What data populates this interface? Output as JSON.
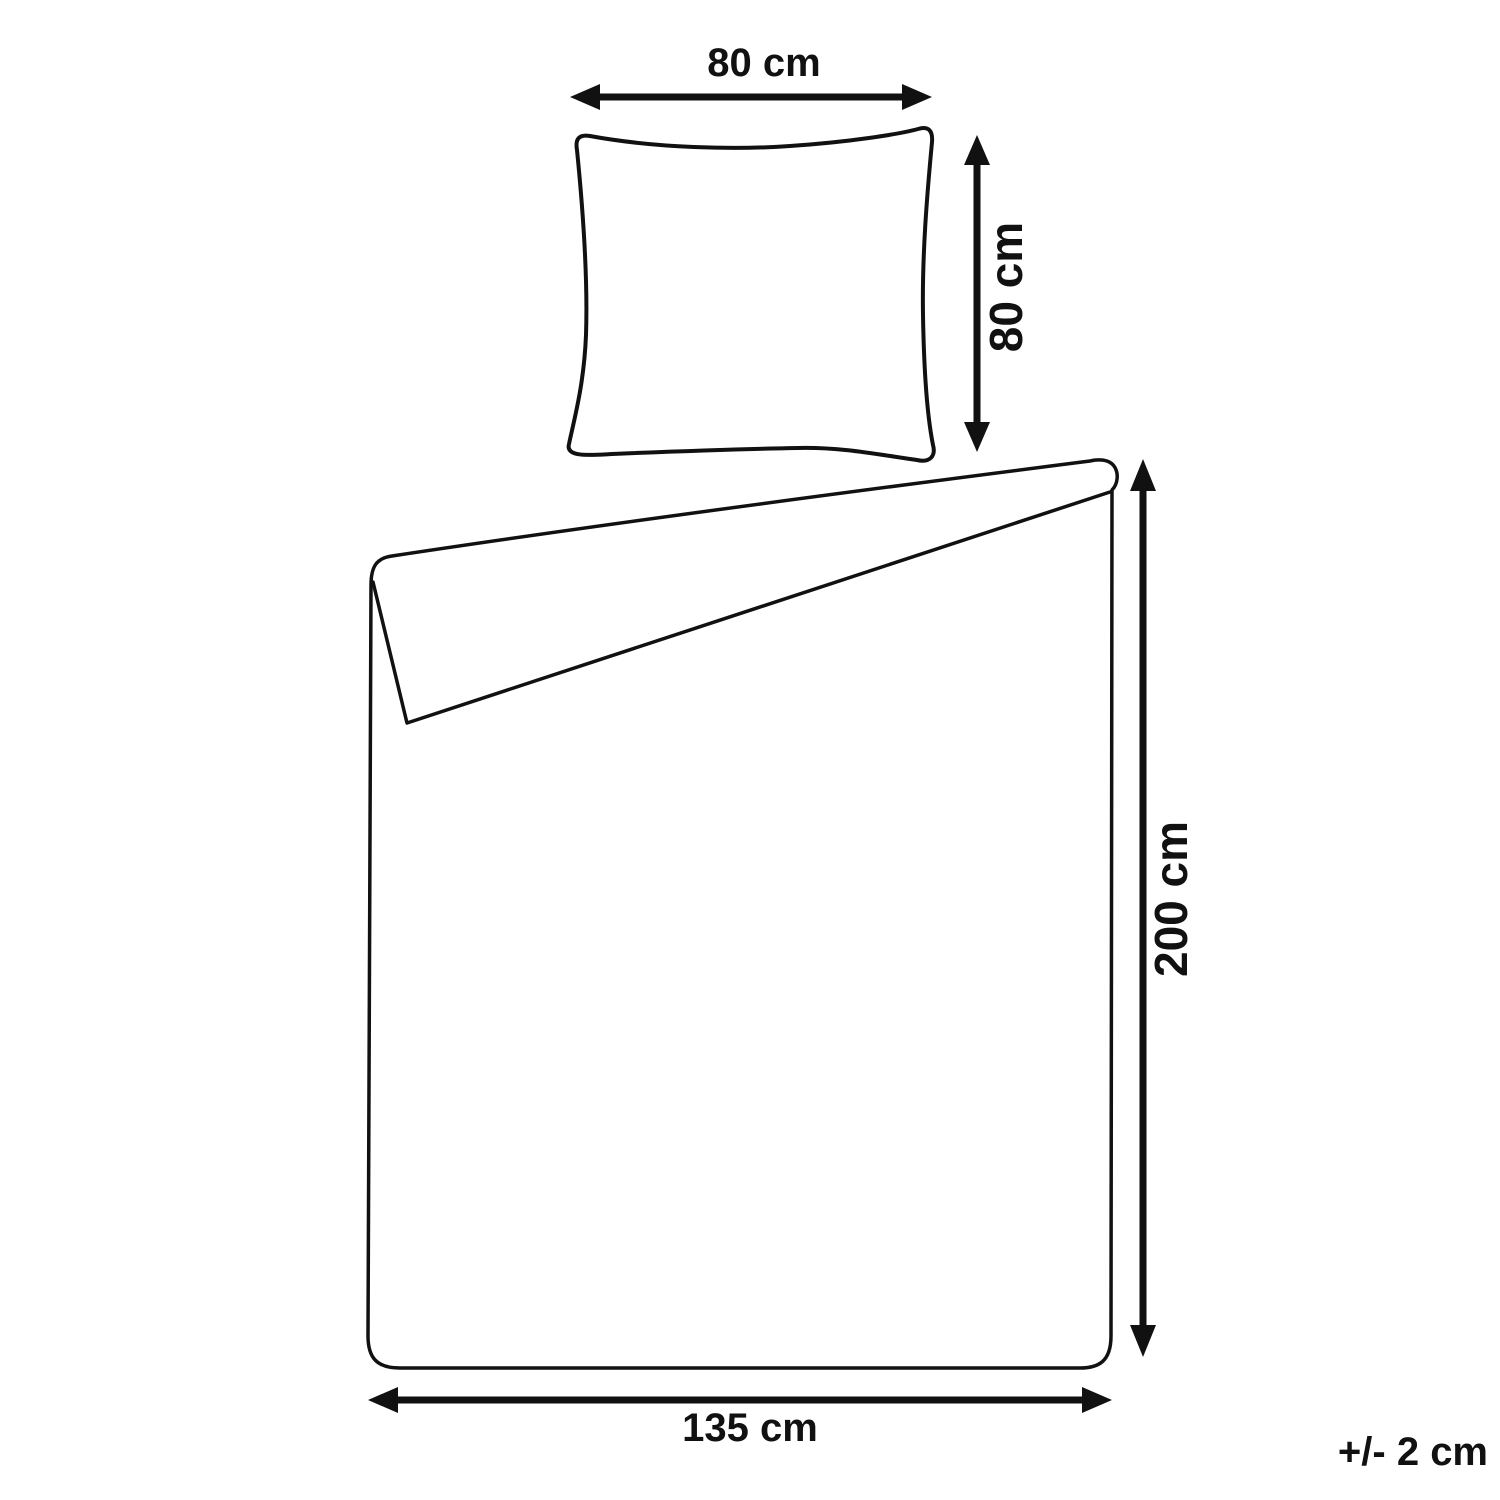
{
  "diagram": {
    "background_color": "#ffffff",
    "line_color": "#111111",
    "pillow": {
      "width_label": "80 cm",
      "height_label": "80 cm",
      "width_cm": 80,
      "height_cm": 80
    },
    "duvet": {
      "width_label": "135 cm",
      "height_label": "200 cm",
      "width_cm": 135,
      "height_cm": 200
    },
    "tolerance_label": "+/- 2 cm"
  }
}
